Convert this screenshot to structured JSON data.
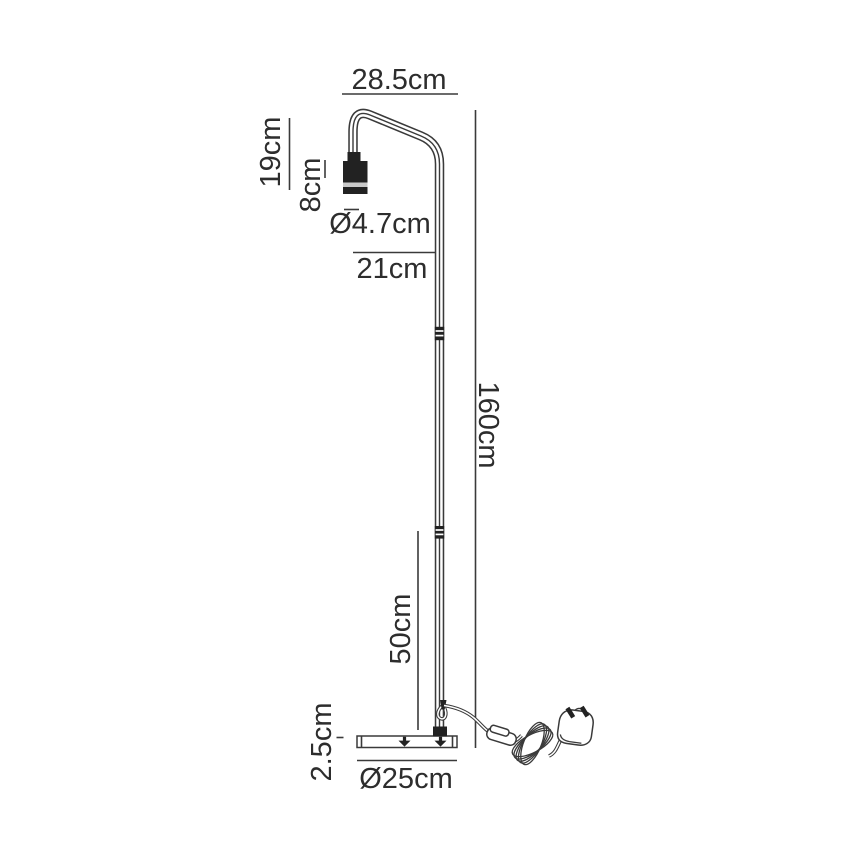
{
  "drawing": {
    "subject": "floor-lamp-dimension-diagram",
    "colors": {
      "background": "#ffffff",
      "line": "#3a3a3a",
      "text": "#2d2d2d",
      "solid_fill": "#222222",
      "socket_band": "#c9c9c9"
    },
    "labels": {
      "arm_width": "28.5cm",
      "head_height": "19cm",
      "socket_height": "8cm",
      "socket_diameter": "Ø4.7cm",
      "arm_projection": "21cm",
      "overall_height": "160cm",
      "lower_pole_height": "50cm",
      "base_thickness": "2.5cm",
      "base_diameter": "Ø25cm"
    }
  }
}
